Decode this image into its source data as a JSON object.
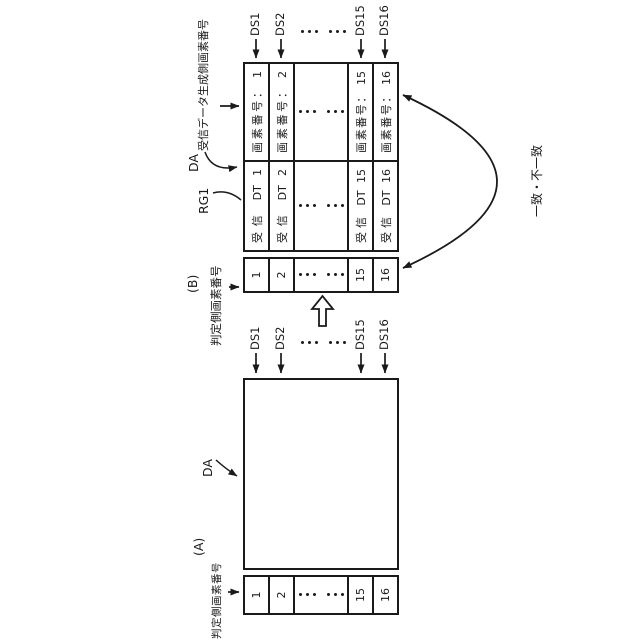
{
  "colors": {
    "ink": "#1a1a1a",
    "background": "#ffffff"
  },
  "figure_a": {
    "label": "(A)",
    "judge_header": "判定側画素番号",
    "da_label": "DA",
    "ds_labels": [
      "DS1",
      "DS2",
      "...",
      "DS15",
      "DS16"
    ],
    "judge_col": [
      "1",
      "2",
      "...",
      "15",
      "16"
    ]
  },
  "figure_b": {
    "label": "(B)",
    "judge_header": "判定側画素番号",
    "recv_header": "受信データ生成側画素番号",
    "da_label": "DA",
    "rg_label": "RG1",
    "match_label": "一致・不一致",
    "ds_labels": [
      "DS1",
      "DS2",
      "...",
      "DS15",
      "DS16"
    ],
    "judge_col": [
      "1",
      "2",
      "...",
      "15",
      "16"
    ],
    "recv_col": [
      "受信 DT 1",
      "受信 DT 2",
      "...",
      "受信 DT 15",
      "受信 DT 16"
    ],
    "pixel_col": [
      "画素番号： 1",
      "画素番号： 2",
      "...",
      "画素番号： 15",
      "画素番号： 16"
    ]
  }
}
